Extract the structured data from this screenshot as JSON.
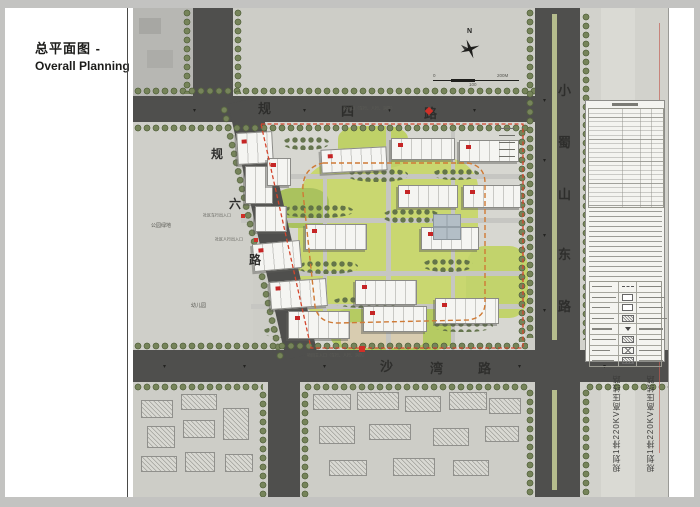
{
  "sidebar": {
    "title_zh": "总平面图 -",
    "title_en": "Overall Planning"
  },
  "compass": {
    "north_label": "N"
  },
  "scalebar": {
    "t0": "0",
    "t1": "100",
    "t2": "200M"
  },
  "roads": {
    "north": {
      "chars": [
        "规",
        "四",
        "路"
      ]
    },
    "east": {
      "chars": [
        "小",
        "蜀",
        "山",
        "东",
        "路"
      ]
    },
    "south": {
      "chars": [
        "沙",
        "湾",
        "路"
      ]
    },
    "west": {
      "chars": [
        "规",
        "六",
        "路"
      ]
    }
  },
  "labels": {
    "park_green": "公园绿地",
    "kindergarten": "幼儿园",
    "vehicle_gate": "社区车行出入口",
    "pedestrian_gate": "社区人行出入口",
    "secondary_entrance": "次入口（车行、人行、消防）",
    "main_entrance": "项目主入口（车行、人行、消防）",
    "power_line_a": "规划1排220KV高压线路",
    "power_line_b": "规划1排220KV高压线路"
  },
  "colors": {
    "road": "#4f4f4d",
    "boundary_red": "#d4452c",
    "fire_lane_orange": "#cf7a35",
    "lawn_green": "#c9d770",
    "tree_green": "#5f7047",
    "building_tag_red": "#c52525"
  }
}
